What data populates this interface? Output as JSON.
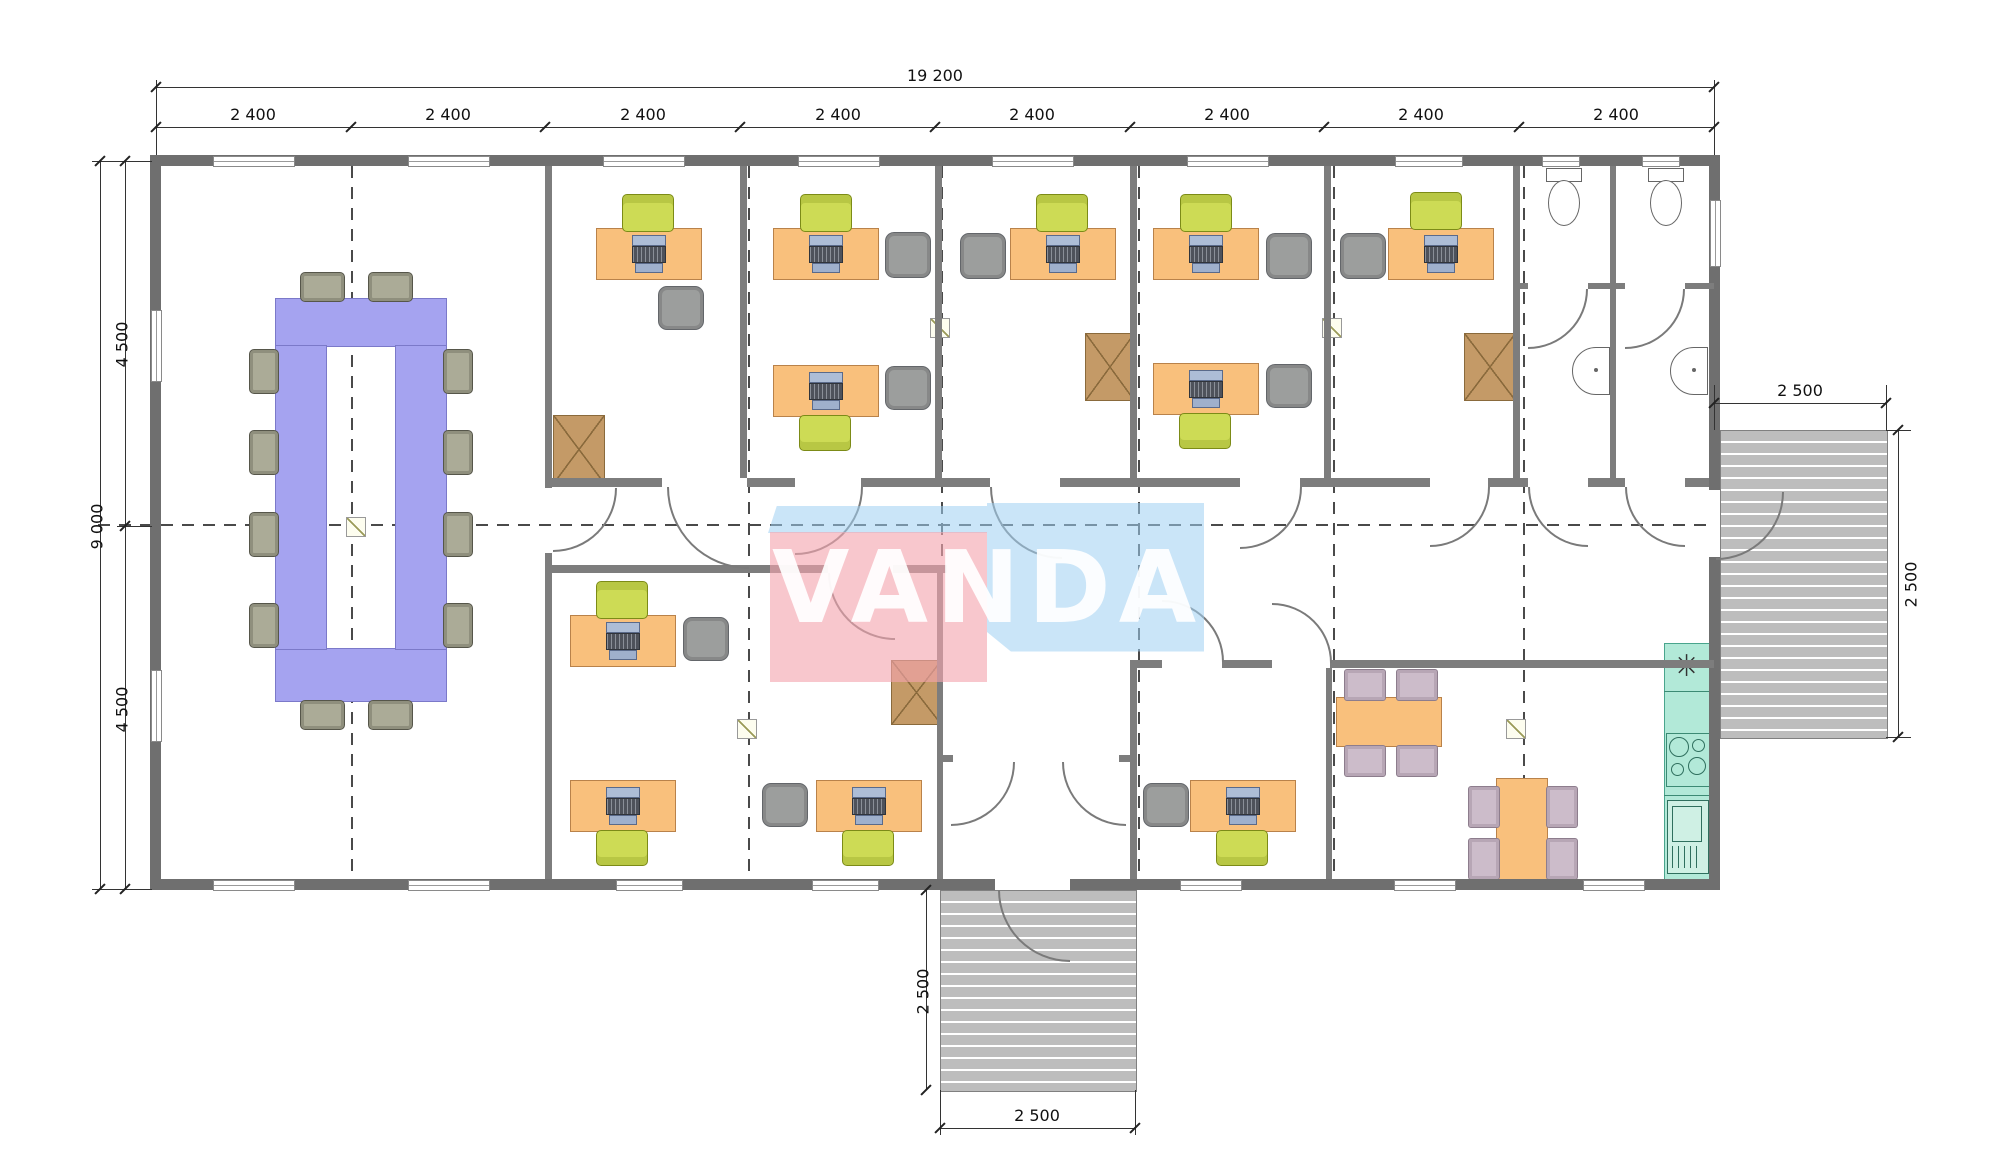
{
  "drawing": {
    "title": "office-floor-plan",
    "logo": {
      "text": "VANDA",
      "pink": "#f4a4af",
      "blue": "#9ed0f2"
    },
    "dimensions": {
      "top_total": "19 200",
      "top_segments": [
        "2 400",
        "2 400",
        "2 400",
        "2 400",
        "2 400",
        "2 400",
        "2 400",
        "2 400"
      ],
      "left_total": "9 000",
      "left_segments": [
        "4 500",
        "4 500"
      ],
      "bottom_porch": {
        "depth": "2 500",
        "width": "2 500"
      },
      "right_porch": {
        "width": "2 500",
        "depth": "2 500"
      }
    },
    "kitchen": {
      "sink_symbol": "✳"
    },
    "colors": {
      "exterior_wall": "#6f6f6f",
      "interior_wall": "#7d7d7d",
      "desk": "#f9c07c",
      "task_chair": "#cddb55",
      "office_chair": "#9c9e9d",
      "conference_table": "#a5a3f0",
      "conference_chair": "#abab97",
      "cabinet": "#c49a67",
      "kitchen_counter": "#b2e9d8",
      "dining_chair": "#ccbcca",
      "porch": "#bdbdbd"
    }
  }
}
